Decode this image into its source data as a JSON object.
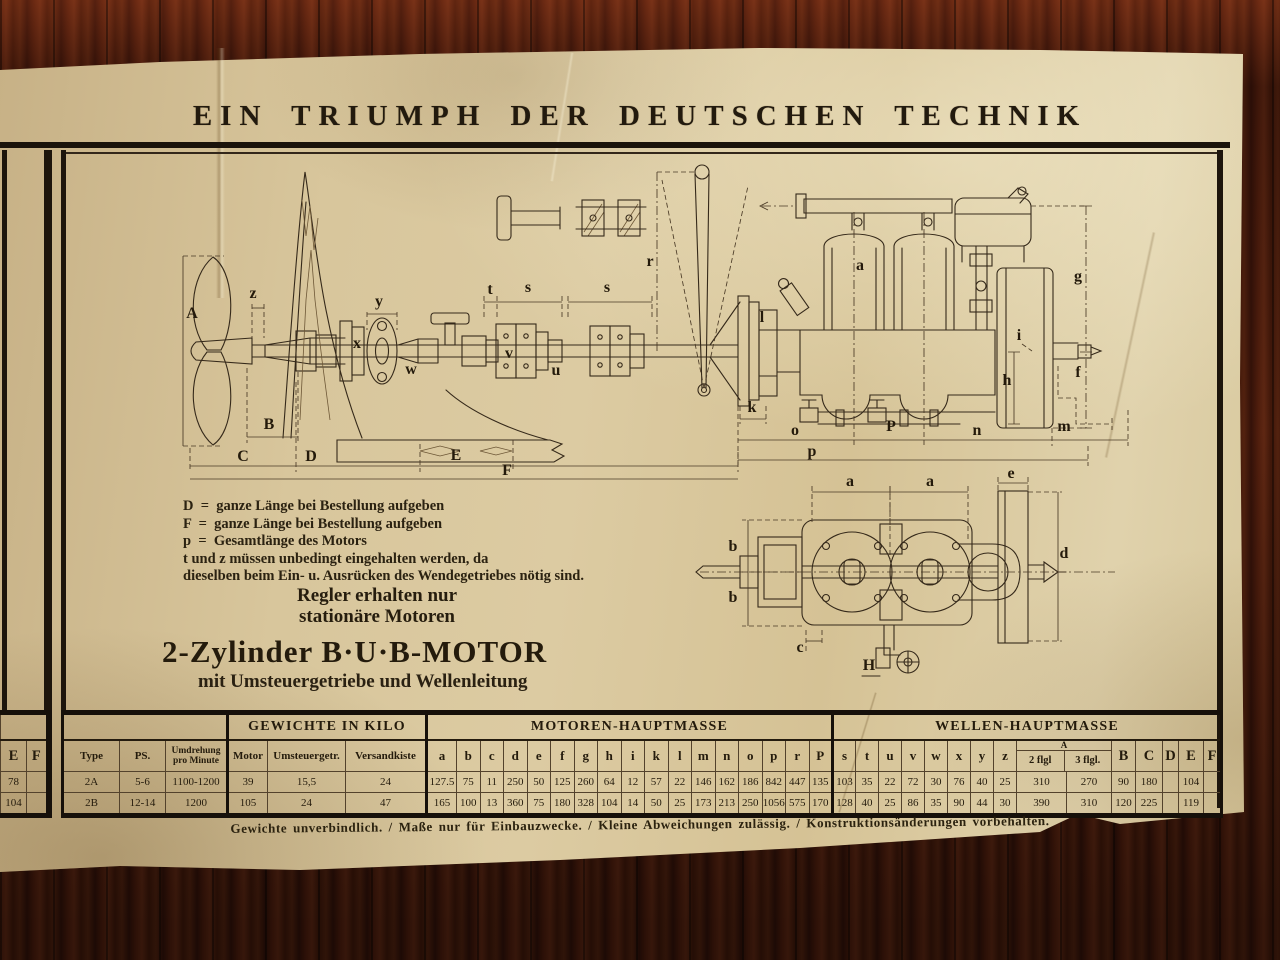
{
  "page": {
    "title": "EIN TRIUMPH DER DEUTSCHEN TECHNIK",
    "notes": [
      "D  =  ganze Länge bei Bestellung aufgeben",
      "F  =  ganze Länge bei Bestellung aufgeben",
      "p  =  Gesamtlänge des Motors",
      "t und z müssen unbedingt eingehalten werden, da",
      "dieselben beim Ein- u. Ausrücken des Wendegetriebes nötig sind."
    ],
    "regler": [
      "Regler erhalten nur",
      "stationäre Motoren"
    ],
    "product_title": "2-Zylinder B·U·B-MOTOR",
    "product_subtitle": "mit Umsteuergetriebe und Wellenleitung",
    "footer": "Gewichte unverbindlich. / Maße nur für Einbauzwecke. / Kleine Abweichungen zulässig. / Konstruktionsänderungen vorbehalten."
  },
  "adjacent_table": {
    "headers": [
      "E",
      "F"
    ],
    "rows": [
      [
        "78",
        ""
      ],
      [
        "104",
        ""
      ]
    ]
  },
  "table": {
    "left": {
      "headers": [
        "Type",
        "PS.",
        "Umdrehung\npro Minute"
      ],
      "rows": [
        [
          "2A",
          "5-6",
          "1100-1200"
        ],
        [
          "2B",
          "12-14",
          "1200"
        ]
      ]
    },
    "gewichte": {
      "title": "GEWICHTE IN KILO",
      "headers": [
        "Motor",
        "Umsteuergetr.",
        "Versandkiste"
      ],
      "rows": [
        [
          "39",
          "15,5",
          "24"
        ],
        [
          "105",
          "24",
          "47"
        ]
      ]
    },
    "motoren": {
      "title": "MOTOREN-HAUPTMASSE",
      "headers": [
        "a",
        "b",
        "c",
        "d",
        "e",
        "f",
        "g",
        "h",
        "i",
        "k",
        "l",
        "m",
        "n",
        "o",
        "p",
        "r",
        "P"
      ],
      "rows": [
        [
          "127.5",
          "75",
          "11",
          "250",
          "50",
          "125",
          "260",
          "64",
          "12",
          "57",
          "22",
          "146",
          "162",
          "186",
          "842",
          "447",
          "135"
        ],
        [
          "165",
          "100",
          "13",
          "360",
          "75",
          "180",
          "328",
          "104",
          "14",
          "50",
          "25",
          "173",
          "213",
          "250",
          "1056",
          "575",
          "170"
        ]
      ]
    },
    "wellen": {
      "title": "WELLEN-HAUPTMASSE",
      "letter_headers": [
        "s",
        "t",
        "u",
        "v",
        "w",
        "x",
        "y",
        "z"
      ],
      "a_label": "A",
      "a_subs": [
        "2 flgl",
        "3 flgl."
      ],
      "tail_headers": [
        "B",
        "C",
        "D",
        "E",
        "F"
      ],
      "rows": [
        [
          "103",
          "35",
          "22",
          "72",
          "30",
          "76",
          "40",
          "25",
          "310",
          "270",
          "90",
          "180",
          "",
          "104",
          ""
        ],
        [
          "128",
          "40",
          "25",
          "86",
          "35",
          "90",
          "44",
          "30",
          "390",
          "310",
          "120",
          "225",
          "",
          "119",
          ""
        ]
      ]
    }
  },
  "drawing": {
    "labels": [
      {
        "t": "A",
        "x": 192,
        "y": 318
      },
      {
        "t": "z",
        "x": 253,
        "y": 298
      },
      {
        "t": "y",
        "x": 379,
        "y": 306
      },
      {
        "t": "x",
        "x": 357,
        "y": 348
      },
      {
        "t": "w",
        "x": 411,
        "y": 374
      },
      {
        "t": "v",
        "x": 509,
        "y": 358
      },
      {
        "t": "u",
        "x": 556,
        "y": 375
      },
      {
        "t": "t",
        "x": 490,
        "y": 294
      },
      {
        "t": "s",
        "x": 528,
        "y": 292
      },
      {
        "t": "s",
        "x": 607,
        "y": 292
      },
      {
        "t": "r",
        "x": 650,
        "y": 266
      },
      {
        "t": "B",
        "x": 269,
        "y": 429
      },
      {
        "t": "C",
        "x": 243,
        "y": 461
      },
      {
        "t": "D",
        "x": 311,
        "y": 461
      },
      {
        "t": "E",
        "x": 456,
        "y": 460
      },
      {
        "t": "F",
        "x": 507,
        "y": 475
      },
      {
        "t": "l",
        "x": 762,
        "y": 322
      },
      {
        "t": "a",
        "x": 860,
        "y": 270
      },
      {
        "t": "k",
        "x": 752,
        "y": 412
      },
      {
        "t": "o",
        "x": 795,
        "y": 435
      },
      {
        "t": "P",
        "x": 891,
        "y": 431
      },
      {
        "t": "n",
        "x": 977,
        "y": 435
      },
      {
        "t": "m",
        "x": 1064,
        "y": 431
      },
      {
        "t": "p",
        "x": 812,
        "y": 456
      },
      {
        "t": "g",
        "x": 1078,
        "y": 281
      },
      {
        "t": "i",
        "x": 1019,
        "y": 340
      },
      {
        "t": "h",
        "x": 1007,
        "y": 385
      },
      {
        "t": "f",
        "x": 1078,
        "y": 377
      },
      {
        "t": "a",
        "x": 850,
        "y": 486
      },
      {
        "t": "a",
        "x": 930,
        "y": 486
      },
      {
        "t": "e",
        "x": 1011,
        "y": 478
      },
      {
        "t": "b",
        "x": 733,
        "y": 551
      },
      {
        "t": "b",
        "x": 733,
        "y": 602
      },
      {
        "t": "c",
        "x": 800,
        "y": 652
      },
      {
        "t": "d",
        "x": 1064,
        "y": 558
      },
      {
        "t": "H",
        "x": 869,
        "y": 670
      }
    ]
  }
}
